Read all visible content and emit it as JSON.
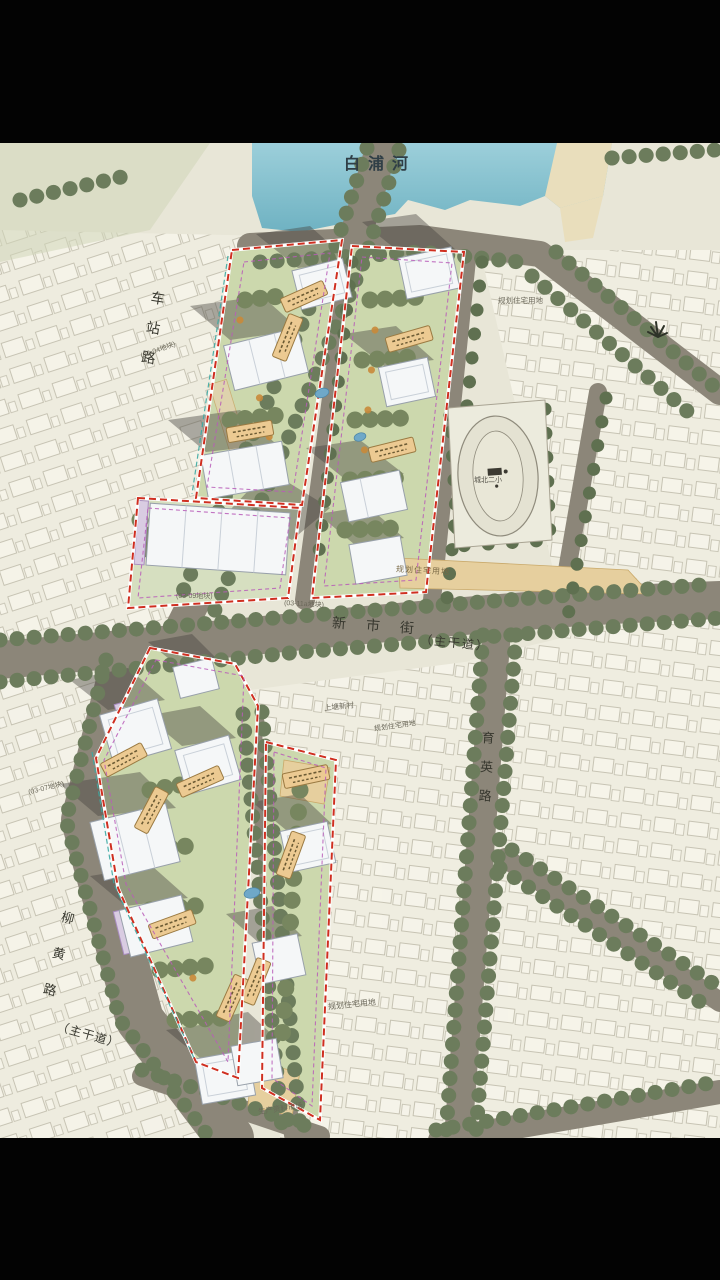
{
  "screen": {
    "top_bar": "letterbox",
    "bottom_bar": "letterbox"
  },
  "map": {
    "labels": {
      "river": "白浦河",
      "station_road": "车站路",
      "station_parcel": "(03-04地块)",
      "xinshi_street": "新市街",
      "xinshi_class": "（主干道）",
      "yuying_road": "育英路",
      "liuhuang_road": "柳黄路",
      "liuhuang_class": "（主干道）",
      "parcel_03_11a": "(03-11a地块)",
      "parcel_03_09": "(03-09地块)",
      "parcel_03_07": "(03-07地块)",
      "planned_res_east": "规划住宅用地",
      "planned_res_mid": "规划住宅用地",
      "planned_res_southeast": "规划住宅用地",
      "planned_res_south": "规划住宅用地",
      "school": "城北二小",
      "village": "上塘新村",
      "market": "生产资料市场"
    },
    "colors": {
      "boundary_red": "#cf2f20",
      "setback_magenta": "#b85cb8",
      "river_blue": "#84bfcc",
      "road_gray": "#8c8679",
      "canvas_cream": "#e8e6d7",
      "tree_green": "#6c7c5c",
      "tag_orange": "#ecca92",
      "building_white": "#f5f7f8"
    }
  }
}
